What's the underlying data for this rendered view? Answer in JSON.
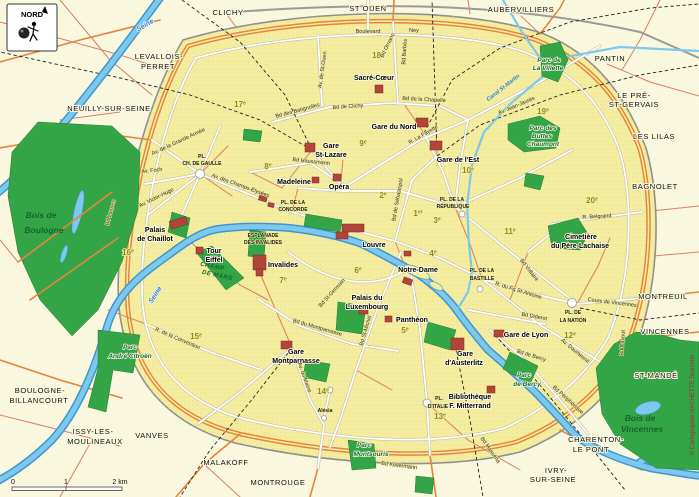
{
  "colors": {
    "suburb_fill": "#faf7df",
    "city_fill": "#f4ed9f",
    "city_dot": "#ddcf7e",
    "park_green": "#33a546",
    "water_fill": "#7ec8ee",
    "water_edge": "#3b97cf",
    "ring_orange": "#e8833d",
    "road_red": "#d97f63",
    "landmark_red": "#b2453a",
    "district_olive": "#8d8a1f",
    "boundary_gray": "#8f8f8f"
  },
  "compass": {
    "label": "NORD"
  },
  "scale": {
    "t0": "0",
    "t1": "1",
    "t2": "2 km"
  },
  "copyright": "© Cartographie HACHETTE Tourisme",
  "water_labels": {
    "seine_nw": "Seine",
    "seine_center": "Seine",
    "canal_st_martin": "Canal St-Martin"
  },
  "suburbs": {
    "clichy": "CLICHY",
    "st_ouen": "ST OUEN",
    "aubervilliers": "AUBERVILLIERS",
    "pantin": "PANTIN",
    "le_pre_1": "LE PRÉ-",
    "le_pre_2": "ST-GERVAIS",
    "les_lilas": "LES LILAS",
    "bagnolet": "BAGNOLET",
    "montreuil": "MONTREUIL",
    "vincennes": "VINCENNES",
    "st_mande": "ST-MANDÉ",
    "charenton_1": "CHARENTON-",
    "charenton_2": "LE PONT",
    "ivry_1": "IVRY-",
    "ivry_2": "SUR-SEINE",
    "montrouge": "MONTROUGE",
    "malakoff": "MALAKOFF",
    "vanves": "VANVES",
    "issy_1": "ISSY-LES-",
    "issy_2": "MOULINEAUX",
    "boulogne_1": "BOULOGNE-",
    "boulogne_2": "BILLANCOURT",
    "levallois_1": "LEVALLOIS-",
    "levallois_2": "PERRET",
    "neuilly": "NEUILLY-SUR-SEINE"
  },
  "districts": {
    "d1": {
      "n": "1",
      "s": "er"
    },
    "d2": {
      "n": "2",
      "s": "e"
    },
    "d3": {
      "n": "3",
      "s": "e"
    },
    "d4": {
      "n": "4",
      "s": "e"
    },
    "d5": {
      "n": "5",
      "s": "e"
    },
    "d6": {
      "n": "6",
      "s": "e"
    },
    "d7": {
      "n": "7",
      "s": "e"
    },
    "d8": {
      "n": "8",
      "s": "e"
    },
    "d9": {
      "n": "9",
      "s": "e"
    },
    "d10": {
      "n": "10",
      "s": "e"
    },
    "d11": {
      "n": "11",
      "s": "e"
    },
    "d12": {
      "n": "12",
      "s": "e"
    },
    "d13": {
      "n": "13",
      "s": "e"
    },
    "d14": {
      "n": "14",
      "s": "e"
    },
    "d15": {
      "n": "15",
      "s": "e"
    },
    "d16": {
      "n": "16",
      "s": "e"
    },
    "d17": {
      "n": "17",
      "s": "e"
    },
    "d18": {
      "n": "18",
      "s": "e"
    },
    "d19": {
      "n": "19",
      "s": "e"
    },
    "d20": {
      "n": "20",
      "s": "e"
    }
  },
  "landmarks": {
    "sacre_coeur": "Sacré-Cœur",
    "gare_du_nord": "Gare du Nord",
    "gare_de_l_est": "Gare de l'Est",
    "st_lazare_1": "Gare",
    "st_lazare_2": "St-Lazare",
    "madeleine": "Madeleine",
    "opera": "Opéra",
    "louvre": "Louvre",
    "notre_dame": "Notre-Dame",
    "chaillot_1": "Palais",
    "chaillot_2": "de Chaillot",
    "eiffel_1": "Tour",
    "eiffel_2": "Eiffel",
    "invalides": "Invalides",
    "lux_1": "Palais du",
    "lux_2": "Luxembourg",
    "pantheon": "Panthéon",
    "montparnasse_1": "Gare",
    "montparnasse_2": "Montparnasse",
    "lyon": "Gare de Lyon",
    "austerlitz_1": "Gare",
    "austerlitz_2": "d'Austerlitz",
    "biblio_1": "Bibliothèque",
    "biblio_2": "F. Mitterrand",
    "lachaise_1": "Cimetière",
    "lachaise_2": "du Père-Lachaise"
  },
  "parks": {
    "bois_b_1": "Bois de",
    "bois_b_2": "Boulogne",
    "bois_v_1": "Bois de",
    "bois_v_2": "Vincennes",
    "villette_1": "Parc de",
    "villette_2": "La Villette",
    "buttes_1": "Parc des",
    "buttes_2": "Buttes",
    "buttes_3": "Chaumont",
    "montsouris_1": "Parc",
    "montsouris_2": "Montsouris",
    "citroen_1": "Parc",
    "citroen_2": "André Citroën",
    "bercy_1": "Parc",
    "bercy_2": "de Bercy",
    "champ_1": "CHAMP",
    "champ_2": "DE MARS"
  },
  "places": {
    "etoile_1": "PL.",
    "etoile_2": "CH. DE GAULLE",
    "concorde_1": "PL. DE LA",
    "concorde_2": "CONCORDE",
    "esplanade_1": "ESPLANADE",
    "esplanade_2": "DES INVALIDES",
    "republique_1": "PL. DE LA",
    "republique_2": "RÉPUBLIQUE",
    "bastille_1": "PL. DE LA",
    "bastille_2": "BASTILLE",
    "nation_1": "PL. DE",
    "nation_2": "LA NATION",
    "italie_1": "PL.",
    "italie_2": "D'ITALIE",
    "alesia": "Alésia"
  },
  "streets": {
    "boulevard": "Boulevard",
    "ney": "Ney",
    "bd_clichy": "Bd de Clichy",
    "bd_chapelle": "Bd de la Chapelle",
    "la_fayette": "R. La Fayette",
    "haussmann": "Bd Haussmann",
    "champs": "Av. des Champs-Élysées",
    "foch": "Av. Foch",
    "victor_hugo": "Av. Victor-Hugo",
    "grande_armee": "Av. de la Grande Armée",
    "lannes": "Bd Lannes",
    "st_ouen_av": "Av. de St-Ouen",
    "ornano": "Bd Ornano",
    "barbes": "Bd Barbès",
    "batignolles": "Bd des Batignolles",
    "jean_jaures": "Av. Jean-Jaurès",
    "sebastopol": "Bd de Sébastopol",
    "st_germain": "Bd St-Germain",
    "st_michel": "Bd St-Michel",
    "bd_montparnasse": "Bd du Montparnasse",
    "belgrand": "R. Belgrand",
    "voltaire": "Bd Voltaire",
    "fg_st_antoine": "R. du Fg St-Antoine",
    "daumesnil": "Av. Daumesnil",
    "cours_vincennes": "Cours de Vincennes",
    "davout": "Bd Davout",
    "peripherique": "Bd Périphérique",
    "kellermann": "Bd Kellermann",
    "massena": "Bd Masséna",
    "bercy": "Bd de Bercy",
    "diderot": "Bd Diderot",
    "convention": "R. de la Convention",
    "maine": "Av. du Maine"
  }
}
